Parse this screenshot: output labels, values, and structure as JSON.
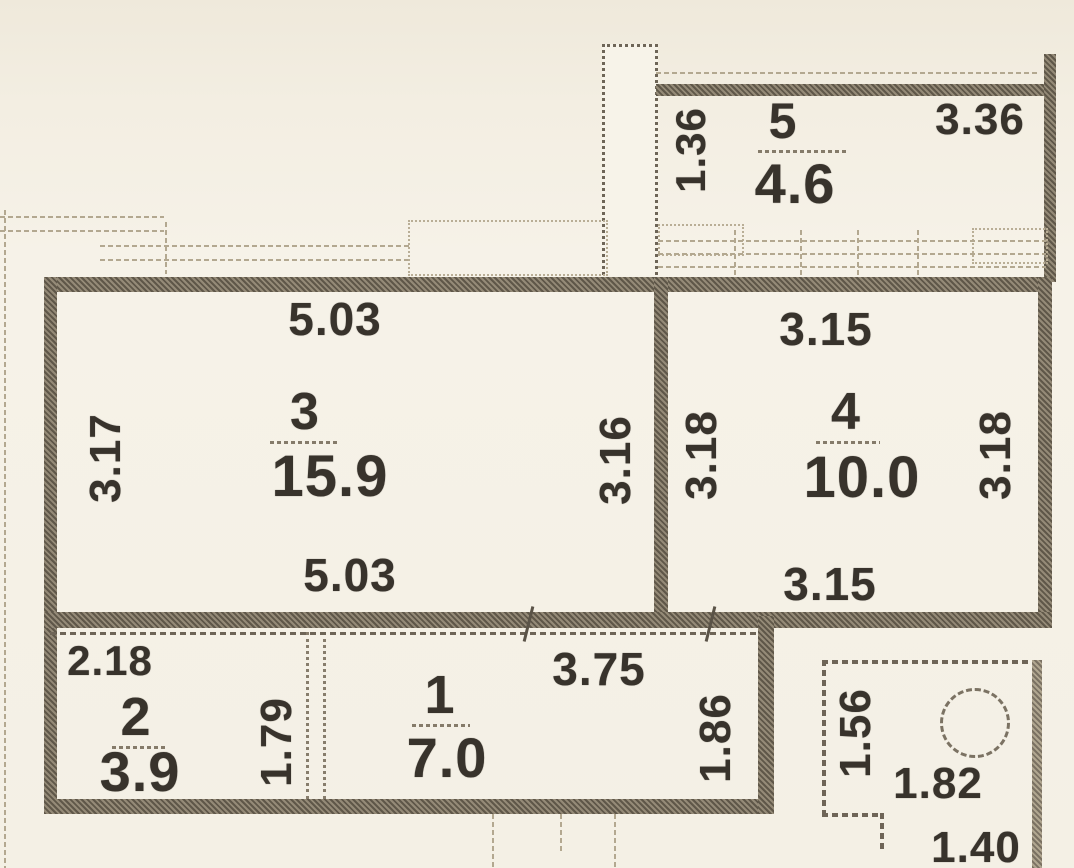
{
  "title": "Apartment floor plan",
  "rooms": {
    "room5": {
      "number": "5",
      "area": "4.6",
      "dim_left": "1.36",
      "dim_top_right": "3.36"
    },
    "room3": {
      "number": "3",
      "area": "15.9",
      "dim_top": "5.03",
      "dim_bottom": "5.03",
      "dim_left": "3.17",
      "dim_right": "3.16"
    },
    "room4": {
      "number": "4",
      "area": "10.0",
      "dim_top": "3.15",
      "dim_bottom": "3.15",
      "dim_left": "3.18",
      "dim_right": "3.18"
    },
    "room2": {
      "number": "2",
      "area": "3.9",
      "dim_top": "2.18",
      "dim_right": "1.79"
    },
    "room1": {
      "number": "1",
      "area": "7.0",
      "dim_top": "3.75",
      "dim_right": "1.86"
    },
    "bathroom": {
      "dim_left": "1.56",
      "dim_width": "1.82",
      "dim_bottom": "1.40"
    }
  },
  "colors": {
    "background": "#f4f0e5",
    "wall": "#5f5749",
    "wall_light": "#948a77",
    "window_line": "#b3a890",
    "text": "#38332c"
  }
}
